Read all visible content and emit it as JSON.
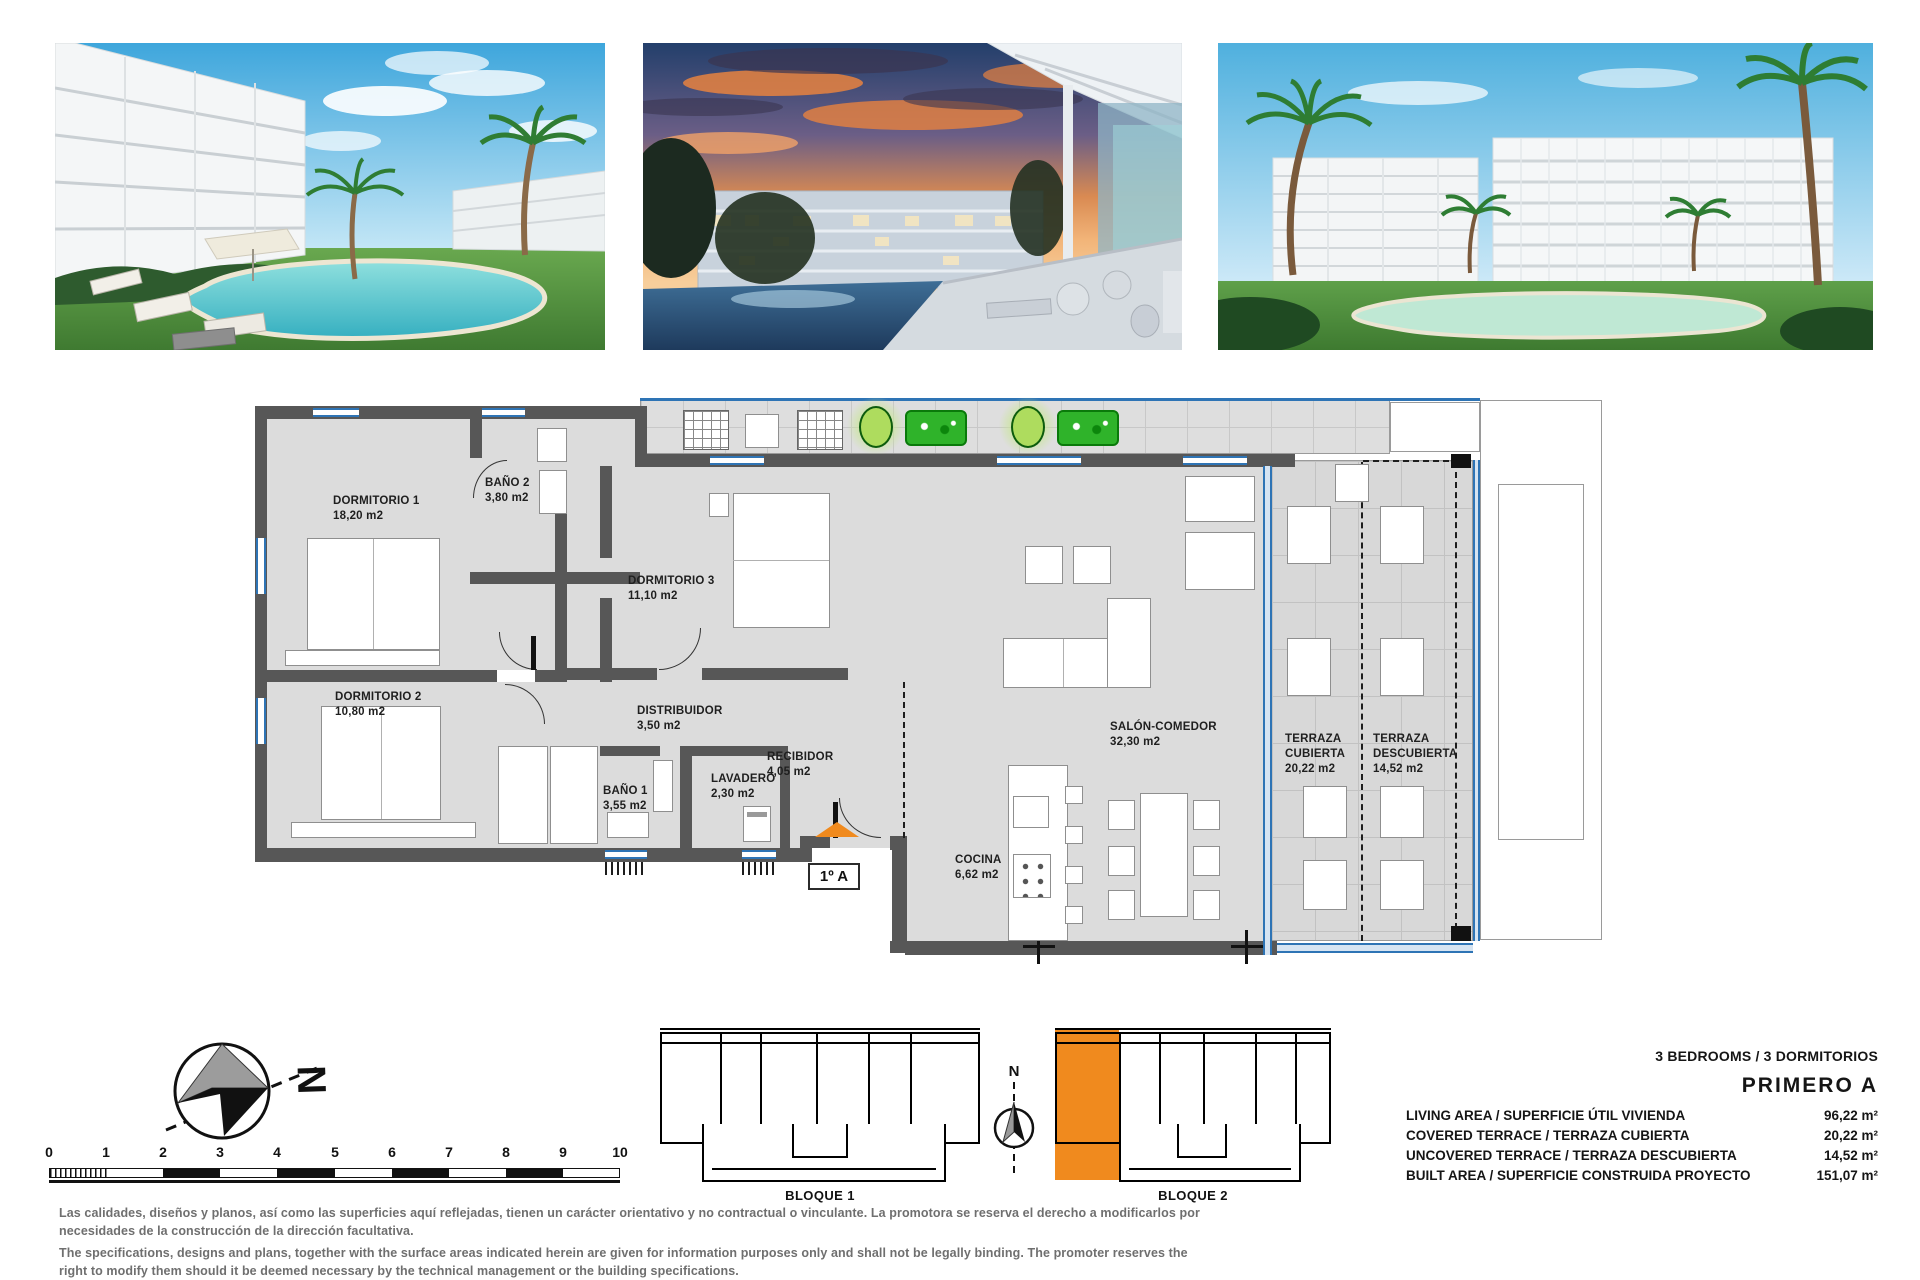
{
  "photos": [
    {
      "name": "render-pool-garden-day"
    },
    {
      "name": "render-terrace-sunset"
    },
    {
      "name": "render-building-pool-day"
    }
  ],
  "plan": {
    "unit_label": "1º A",
    "rooms": [
      {
        "name": "DORMITORIO 1",
        "area": "18,20 m2"
      },
      {
        "name": "BAÑO 2",
        "area": "3,80 m2"
      },
      {
        "name": "DORMITORIO 3",
        "area": "11,10 m2"
      },
      {
        "name": "DORMITORIO 2",
        "area": "10,80 m2"
      },
      {
        "name": "DISTRIBUIDOR",
        "area": "3,50 m2"
      },
      {
        "name": "BAÑO 1",
        "area": "3,55 m2"
      },
      {
        "name": "LAVADERO",
        "area": "2,30 m2"
      },
      {
        "name": "RECIBIDOR",
        "area": "4,05 m2"
      },
      {
        "name": "COCINA",
        "area": "6,62 m2"
      },
      {
        "name": "SALÓN-COMEDOR",
        "area": "32,30 m2"
      },
      {
        "name": "TERRAZA CUBIERTA",
        "area": "20,22 m2"
      },
      {
        "name": "TERRAZA DESCUBIERTA",
        "area": "14,52 m2"
      }
    ]
  },
  "compass": {
    "north_label": "N"
  },
  "scalebar": {
    "ticks": [
      "0",
      "1",
      "2",
      "3",
      "4",
      "5",
      "6",
      "7",
      "8",
      "9",
      "10"
    ]
  },
  "keyplan": {
    "north_label": "N",
    "block1_label": "BLOQUE 1",
    "block2_label": "BLOQUE 2"
  },
  "specs": {
    "header": "3 BEDROOMS / 3 DORMITORIOS",
    "unit_name": "PRIMERO A",
    "rows": [
      {
        "label": "LIVING AREA / SUPERFICIE ÚTIL VIVIENDA",
        "value": "96,22 m²"
      },
      {
        "label": "COVERED TERRACE / TERRAZA CUBIERTA",
        "value": "20,22 m²"
      },
      {
        "label": "UNCOVERED TERRACE / TERRAZA DESCUBIERTA",
        "value": "14,52 m²"
      },
      {
        "label": "BUILT AREA / SUPERFICIE CONSTRUIDA PROYECTO",
        "value": "151,07 m²"
      }
    ]
  },
  "disclaimer": {
    "line1": "Las calidades, diseños y planos, así como las superficies aquí reflejadas, tienen un carácter orientativo y no contractual o vinculante. La promotora se reserva el derecho a modificarlos por",
    "line2": "necesidades de la construcción de la dirección facultativa.",
    "line3": "The specifications, designs and plans, together with the surface areas indicated herein are given for information purposes only and shall not be legally binding. The promoter reserves the",
    "line4": "right to modify them should it be deemed necessary by the technical management or the building specifications."
  },
  "colors": {
    "accent_orange": "#F08A1E",
    "window_blue": "#2E74B5",
    "wall_gray": "#575757",
    "plant_green": "#2FB32A"
  }
}
